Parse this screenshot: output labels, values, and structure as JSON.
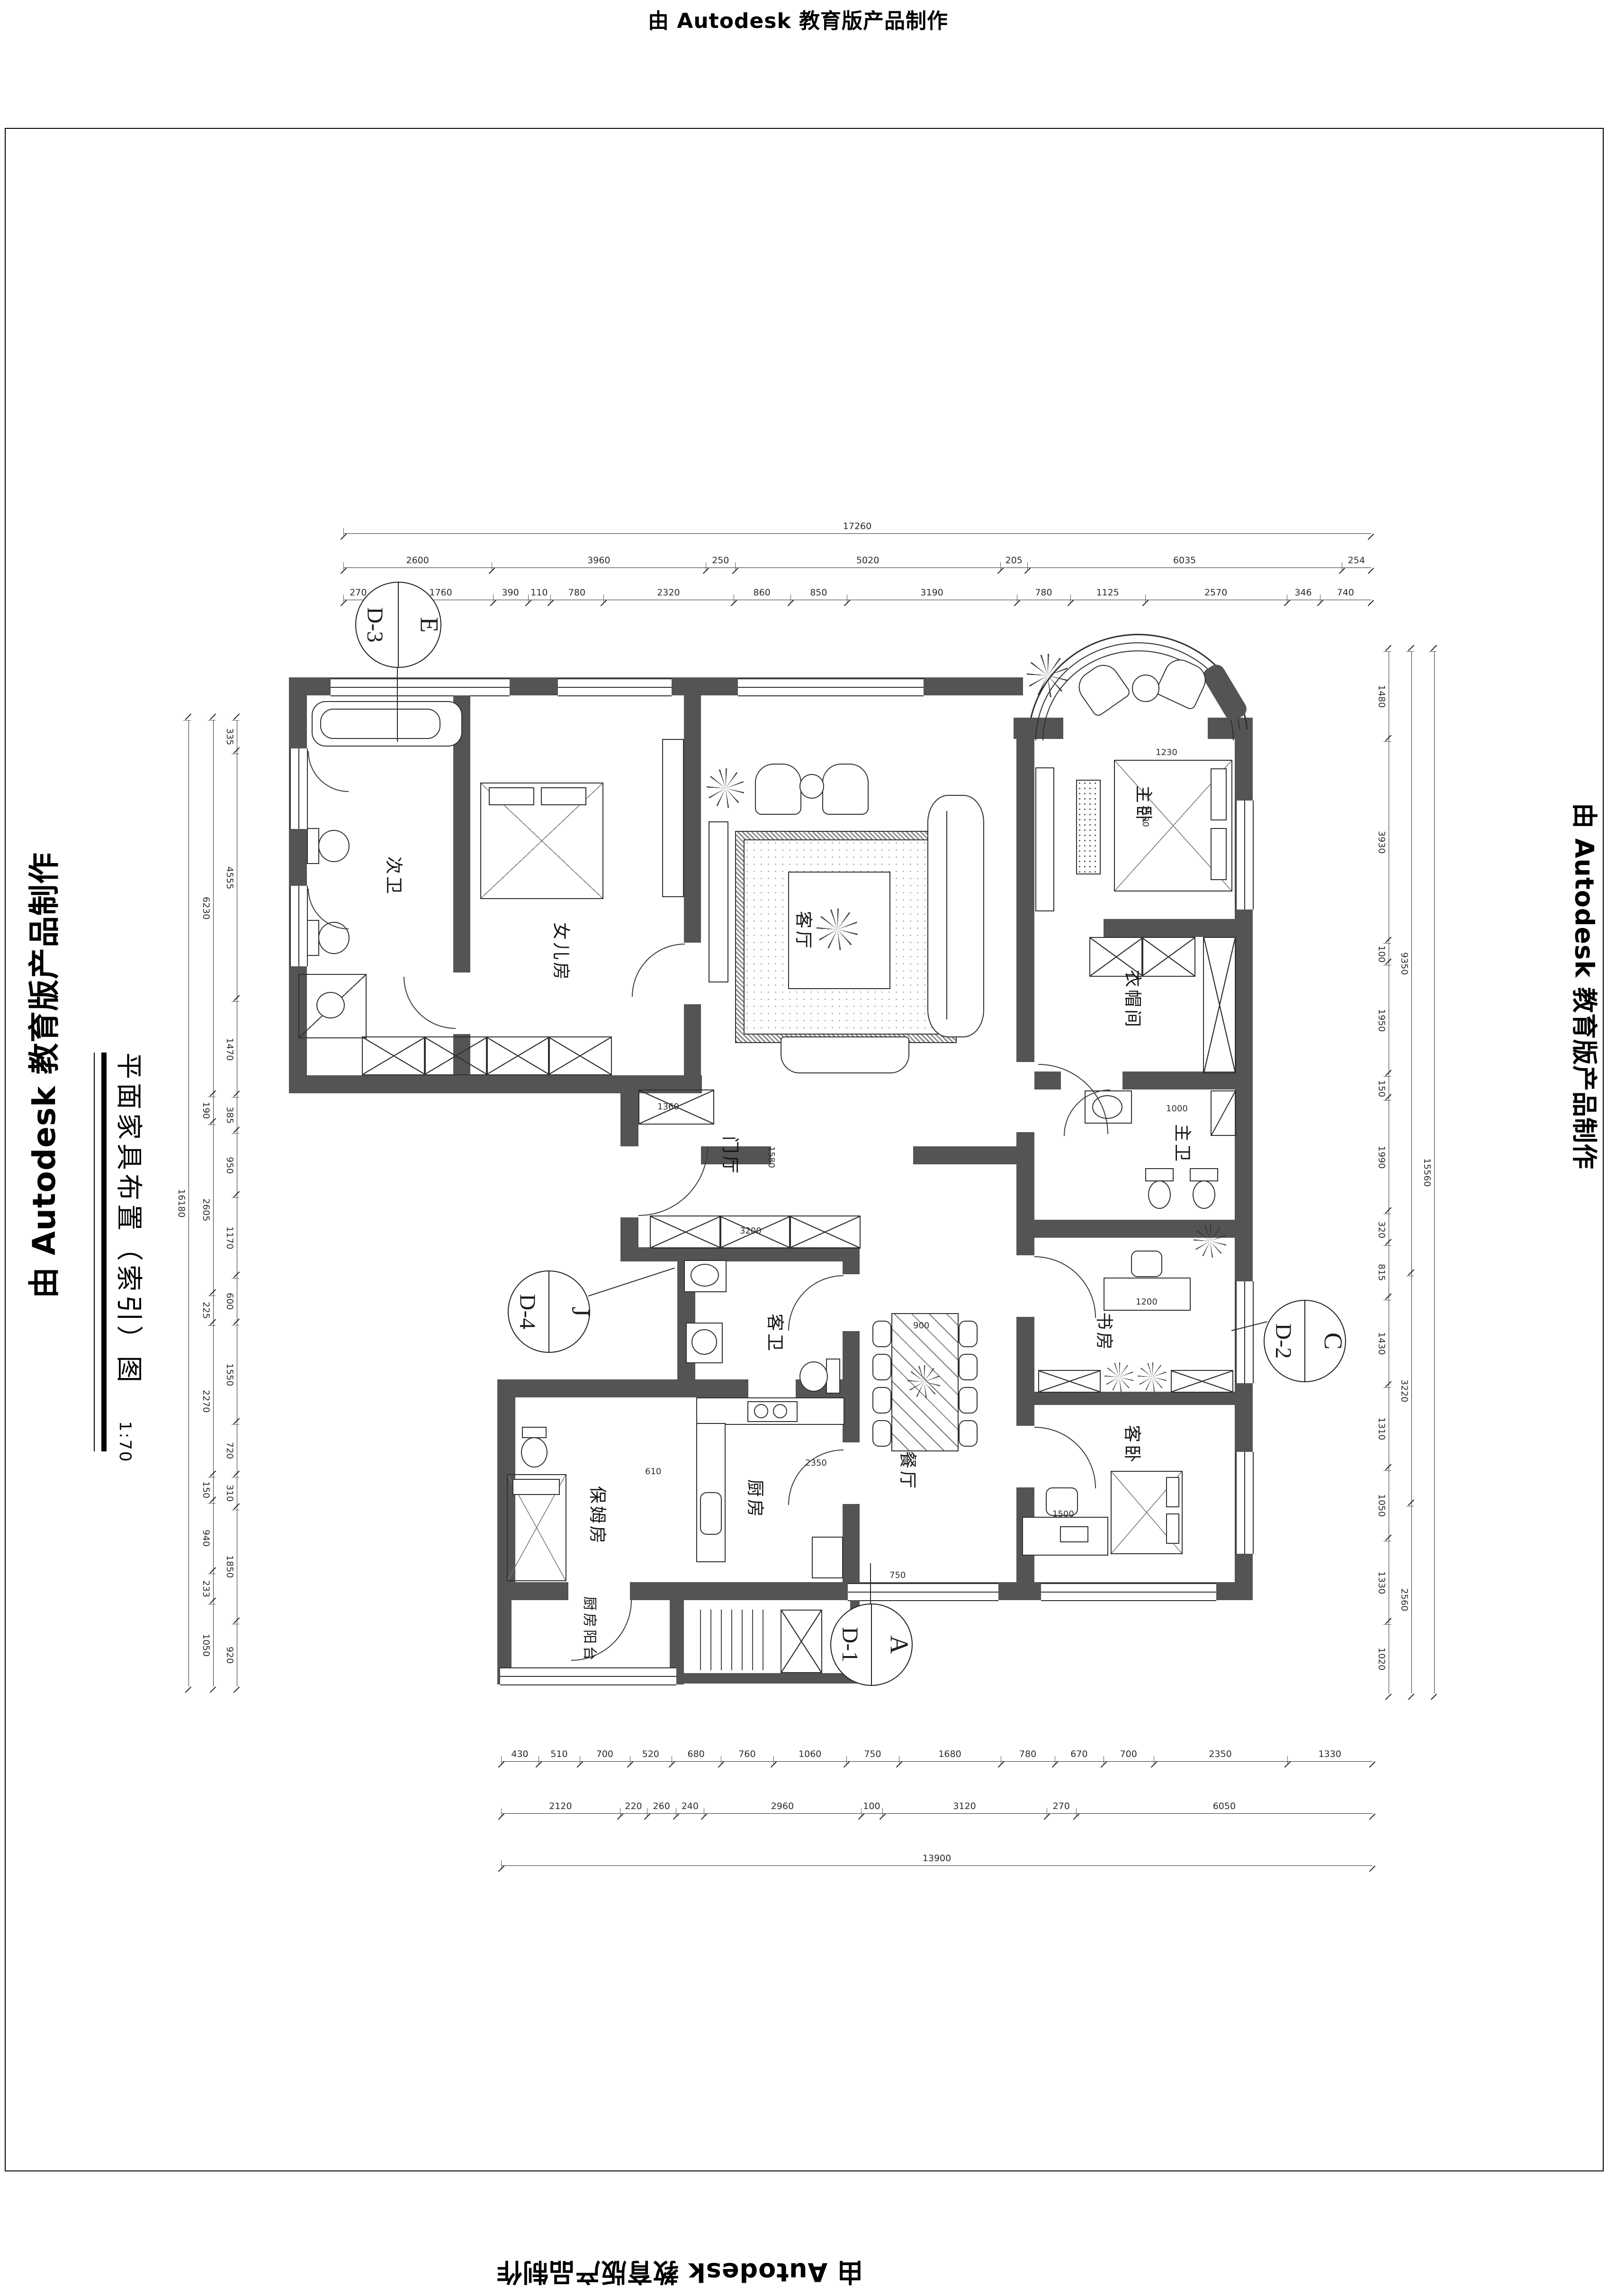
{
  "watermarks": {
    "top": "由 Autodesk 教育版产品制作",
    "bottom": "由 Autodesk 教育版产品制作",
    "left": "由 Autodesk 教育版产品制作",
    "right": "由 Autodesk 教育版产品制作"
  },
  "title": {
    "name": "平面家具布置（索引）图",
    "scale": "1:70"
  },
  "rooms": {
    "ci_wei": "次卫",
    "nver_fang": "女儿房",
    "ke_ting": "客厅",
    "zhu_wo": "主卧",
    "yimaojian": "衣帽间",
    "zhu_wei": "主卫",
    "men_ting": "门厅",
    "ke_wei": "客卫",
    "shu_fang": "书房",
    "can_ting": "餐厅",
    "chu_fang": "厨房",
    "baomu_fang": "保姆房",
    "ke_wo": "客卧",
    "chufang_yangtai": "厨房阳台"
  },
  "markers": {
    "e": {
      "letter": "E",
      "code": "D-3"
    },
    "j": {
      "letter": "J",
      "code": "D-4"
    },
    "c": {
      "letter": "C",
      "code": "D-2"
    },
    "a": {
      "letter": "A",
      "code": "D-1"
    }
  },
  "dims": {
    "top": {
      "overall": [
        "17260"
      ],
      "major": [
        "2600",
        "3960",
        "250",
        "5020",
        "205",
        "6035",
        "254"
      ],
      "minor": [
        "270",
        "90",
        "1760",
        "390",
        "110",
        "780",
        "2320",
        "860",
        "850",
        "3190",
        "780",
        "1125",
        "2570",
        "346",
        "740"
      ]
    },
    "bottom": {
      "minor": [
        "430",
        "510",
        "700",
        "520",
        "680",
        "760",
        "1060",
        "750",
        "1680",
        "780",
        "670",
        "700",
        "2350",
        "1330"
      ],
      "major": [
        "2120",
        "220",
        "260",
        "240",
        "2960",
        "100",
        "3120",
        "270",
        "6050"
      ],
      "overall": [
        "13900"
      ]
    },
    "left": {
      "outer": [
        "16180"
      ],
      "middle": [
        "6230",
        "190",
        "2605",
        "225",
        "2270",
        "150",
        "940",
        "233",
        "1050"
      ],
      "inner": [
        "335",
        "4555",
        "1470",
        "385",
        "950",
        "1170",
        "600",
        "1550",
        "720",
        "310",
        "1850",
        "920"
      ]
    },
    "right": {
      "inner": [
        "1480",
        "3930",
        "100",
        "1950",
        "150",
        "1990",
        "320",
        "815",
        "1430",
        "1310",
        "1050",
        "1330",
        "1020"
      ],
      "middle": [
        "9350",
        "3220",
        "2560"
      ],
      "outer": [
        "15560"
      ]
    }
  },
  "interior": {
    "closet": "3200",
    "shoe": "1360",
    "hall": "1580",
    "bed_w": "1230",
    "bed_l": "2100",
    "table": "900",
    "desk": "1200",
    "pc_desk": "1500",
    "door": "750",
    "nanny_door": "610",
    "counter": "2350",
    "bath": "1000"
  }
}
